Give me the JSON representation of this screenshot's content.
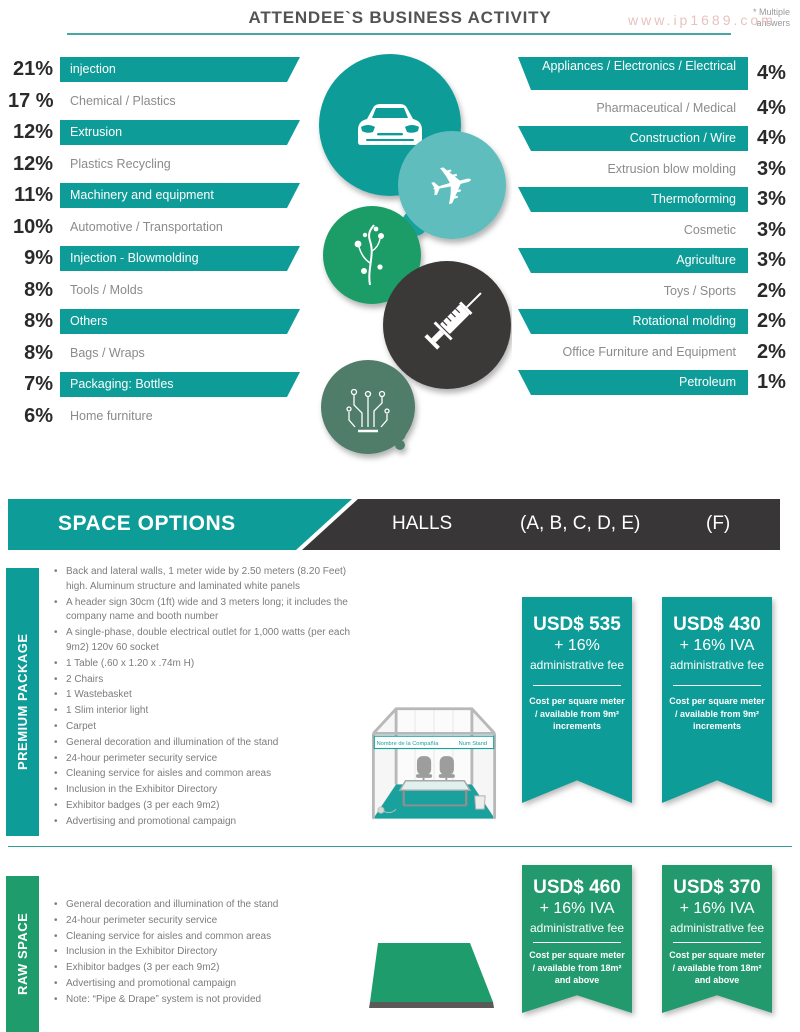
{
  "watermark": "www.ip1689.com",
  "header": {
    "title": "ATTENDEE`S BUSINESS ACTIVITY",
    "note": "* Multiple answers"
  },
  "colors": {
    "teal": "#0E9C98",
    "light_teal": "#5FBDBE",
    "green": "#1F9C66",
    "muted_green": "#4F7D6B",
    "dark": "#3B3839",
    "raw_green": "#229A6D"
  },
  "activity": {
    "left": [
      {
        "pct": "21%",
        "label": "injection",
        "bar": true
      },
      {
        "pct": "17 %",
        "label": "Chemical / Plastics",
        "bar": false
      },
      {
        "pct": "12%",
        "label": "Extrusion",
        "bar": true
      },
      {
        "pct": "12%",
        "label": "Plastics Recycling",
        "bar": false
      },
      {
        "pct": "11%",
        "label": "Machinery and equipment",
        "bar": true
      },
      {
        "pct": "10%",
        "label": "Automotive / Transportation",
        "bar": false
      },
      {
        "pct": "9%",
        "label": "Injection - Blowmolding",
        "bar": true
      },
      {
        "pct": "8%",
        "label": "Tools / Molds",
        "bar": false
      },
      {
        "pct": "8%",
        "label": "Others",
        "bar": true
      },
      {
        "pct": "8%",
        "label": "Bags / Wraps",
        "bar": false
      },
      {
        "pct": "7%",
        "label": "Packaging: Bottles",
        "bar": true
      },
      {
        "pct": "6%",
        "label": "Home furniture",
        "bar": false
      }
    ],
    "right": [
      {
        "pct": "4%",
        "label": "Appliances / Electronics / Electrical",
        "bar": true,
        "tall": true
      },
      {
        "pct": "4%",
        "label": "Pharmaceutical / Medical",
        "bar": false
      },
      {
        "pct": "4%",
        "label": "Construction / Wire",
        "bar": true
      },
      {
        "pct": "3%",
        "label": "Extrusion blow molding",
        "bar": false
      },
      {
        "pct": "3%",
        "label": "Thermoforming",
        "bar": true
      },
      {
        "pct": "3%",
        "label": "Cosmetic",
        "bar": false
      },
      {
        "pct": "3%",
        "label": "Agriculture",
        "bar": true
      },
      {
        "pct": "2%",
        "label": "Toys / Sports",
        "bar": false
      },
      {
        "pct": "2%",
        "label": "Rotational molding",
        "bar": true
      },
      {
        "pct": "2%",
        "label": "Office Furniture and Equipment",
        "bar": false
      },
      {
        "pct": "1%",
        "label": "Petroleum",
        "bar": true
      }
    ]
  },
  "space_options": {
    "title": "SPACE OPTIONS",
    "halls_label": "HALLS",
    "halls_main": "(A, B, C, D, E)",
    "halls_f": "(F)"
  },
  "premium": {
    "label": "PREMIUM PACKAGE",
    "bullets": [
      "Back and lateral walls, 1 meter wide by 2.50 meters (8.20 Feet) high. Aluminum structure and laminated white panels",
      "A header sign 30cm (1ft) wide and 3 meters long; it includes the company name and booth number",
      "A single-phase, double electrical outlet for 1,000 watts (per each 9m2) 120v 60 socket",
      "1 Table (.60 x 1.20 x .74m H)",
      "2 Chairs",
      "1 Wastebasket",
      "1 Slim interior light",
      "Carpet",
      "General decoration and illumination of the stand",
      "24-hour perimeter security service",
      "Cleaning service for aisles and common areas",
      "Inclusion in the Exhibitor Directory",
      "Exhibitor badges (3 per each 9m2)",
      "Advertising and promotional campaign"
    ],
    "booth": {
      "sign_left": "Nombre de la Compañía",
      "sign_right": "Num Stand"
    },
    "ribbons": [
      {
        "price": "USD$ 535",
        "tax": "+ 16%",
        "fee": "administrative fee",
        "note": "Cost per square meter / available from 9m² increments"
      },
      {
        "price": "USD$ 430",
        "tax": "+ 16% IVA",
        "fee": "administrative fee",
        "note": "Cost per square meter / available from 9m² increments"
      }
    ]
  },
  "raw": {
    "label": "RAW SPACE",
    "bullets": [
      "General decoration and illumination of the stand",
      "24-hour perimeter security service",
      "Cleaning service for aisles and common areas",
      "Inclusion in the Exhibitor Directory",
      "Exhibitor badges (3 per each 9m2)",
      "Advertising and promotional campaign",
      "Note: “Pipe & Drape” system is not provided"
    ],
    "ribbons": [
      {
        "price": "USD$ 460",
        "tax": "+ 16% IVA",
        "fee": "administrative fee",
        "note": "Cost per square meter / available from 18m² and above"
      },
      {
        "price": "USD$ 370",
        "tax": "+ 16% IVA",
        "fee": "administrative fee",
        "note": "Cost per square meter / available from 18m² and above"
      }
    ]
  }
}
